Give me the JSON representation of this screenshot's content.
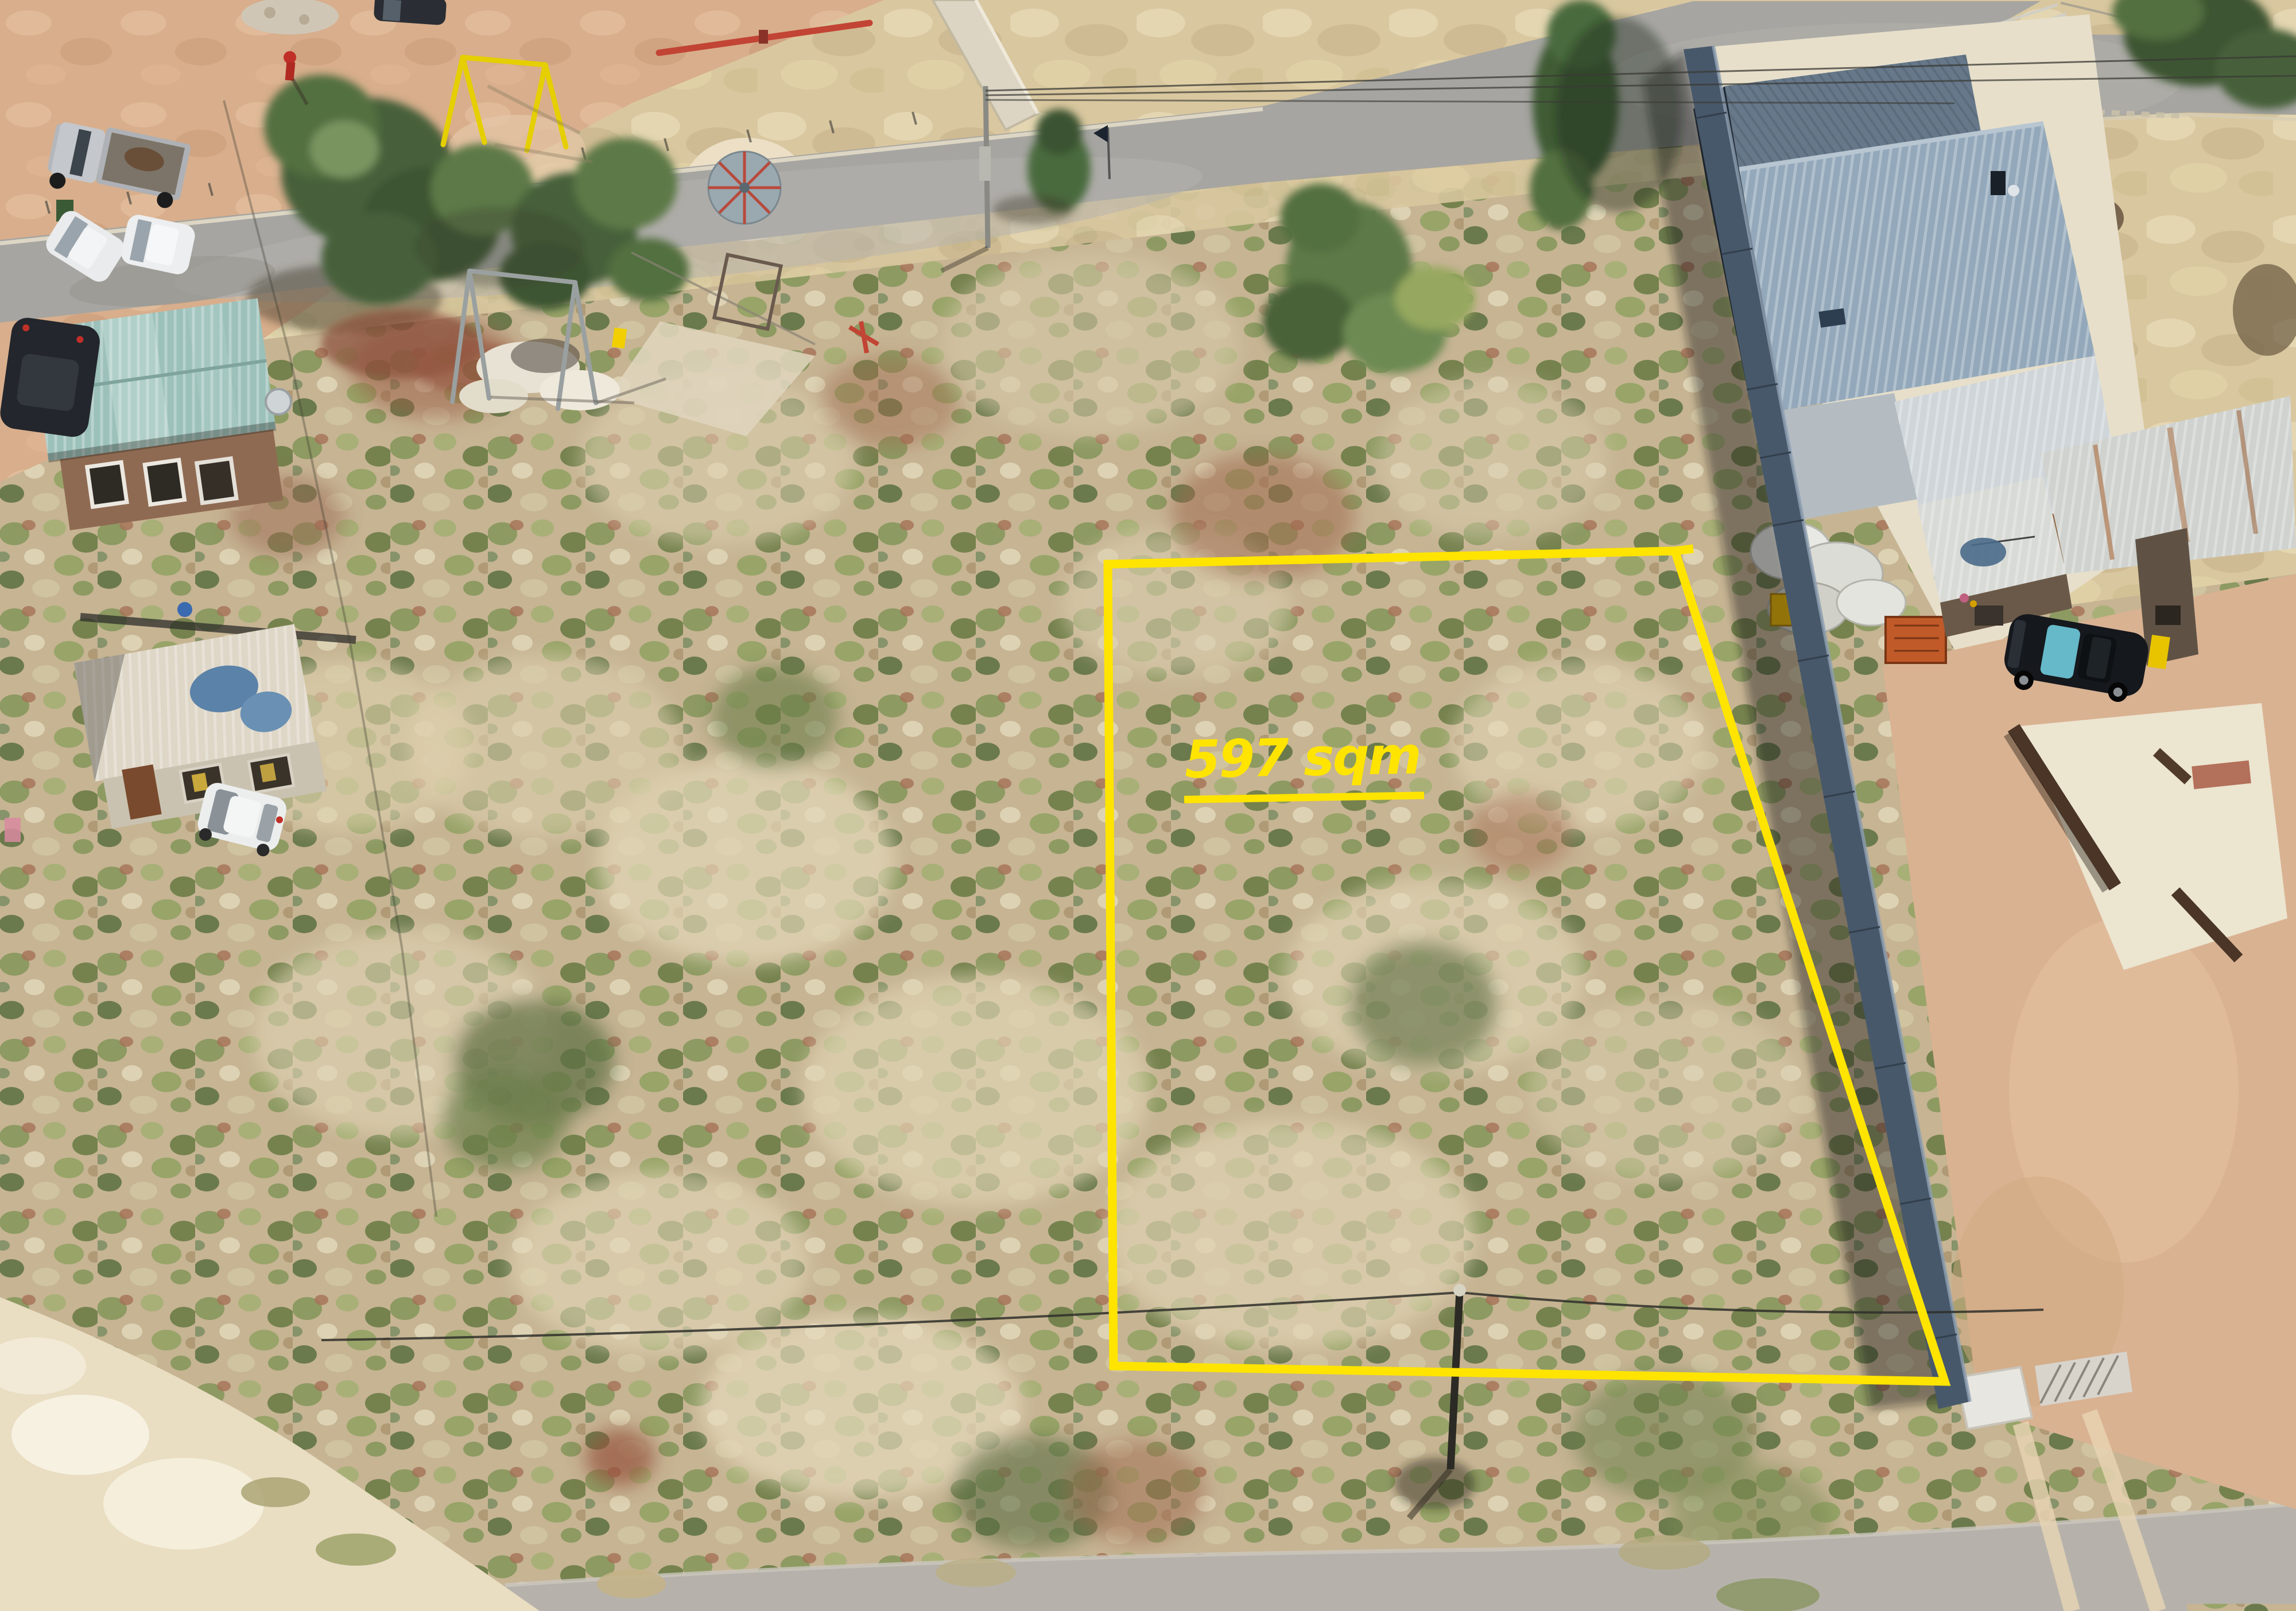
{
  "annotation": {
    "area_label": "597 sqm",
    "label_color": "#FFE400",
    "underlined": true
  },
  "colors": {
    "boundary_yellow": "#FFE400",
    "road_gray": "#A6A5A1",
    "scrub_tan": "#C6B493",
    "dry_grass": "#D9C79F",
    "playground_dirt": "#D8AE8C",
    "teal_roof": "#9CC0BA",
    "blue_house_roof": "#93A8BA",
    "precast_wall": "#47586A",
    "bottom_road_gray": "#B6B2AB"
  }
}
